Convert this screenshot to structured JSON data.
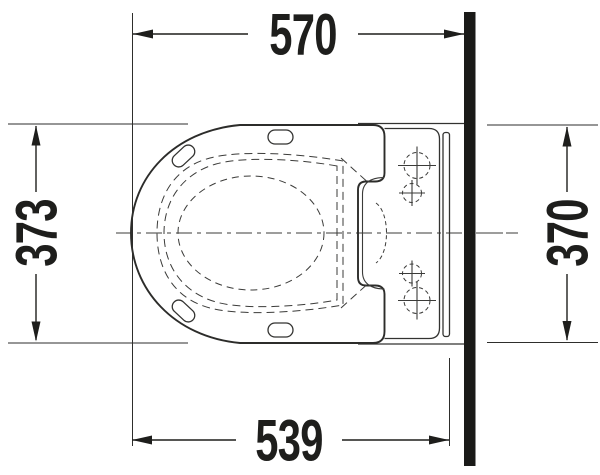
{
  "drawing": {
    "type": "technical-dimension-drawing",
    "view": "top-plan-view",
    "subject": "wall-hung-toilet-with-seat",
    "dimensions": {
      "top": {
        "value": "570",
        "orientation": "horizontal"
      },
      "left": {
        "value": "373",
        "orientation": "vertical"
      },
      "right": {
        "value": "370",
        "orientation": "vertical"
      },
      "bottom": {
        "value": "539",
        "orientation": "horizontal"
      }
    },
    "colors": {
      "background": "#ffffff",
      "ink": "#1e1e1c",
      "outline": "#2c2c2a",
      "detail": "#3b3b39"
    }
  }
}
